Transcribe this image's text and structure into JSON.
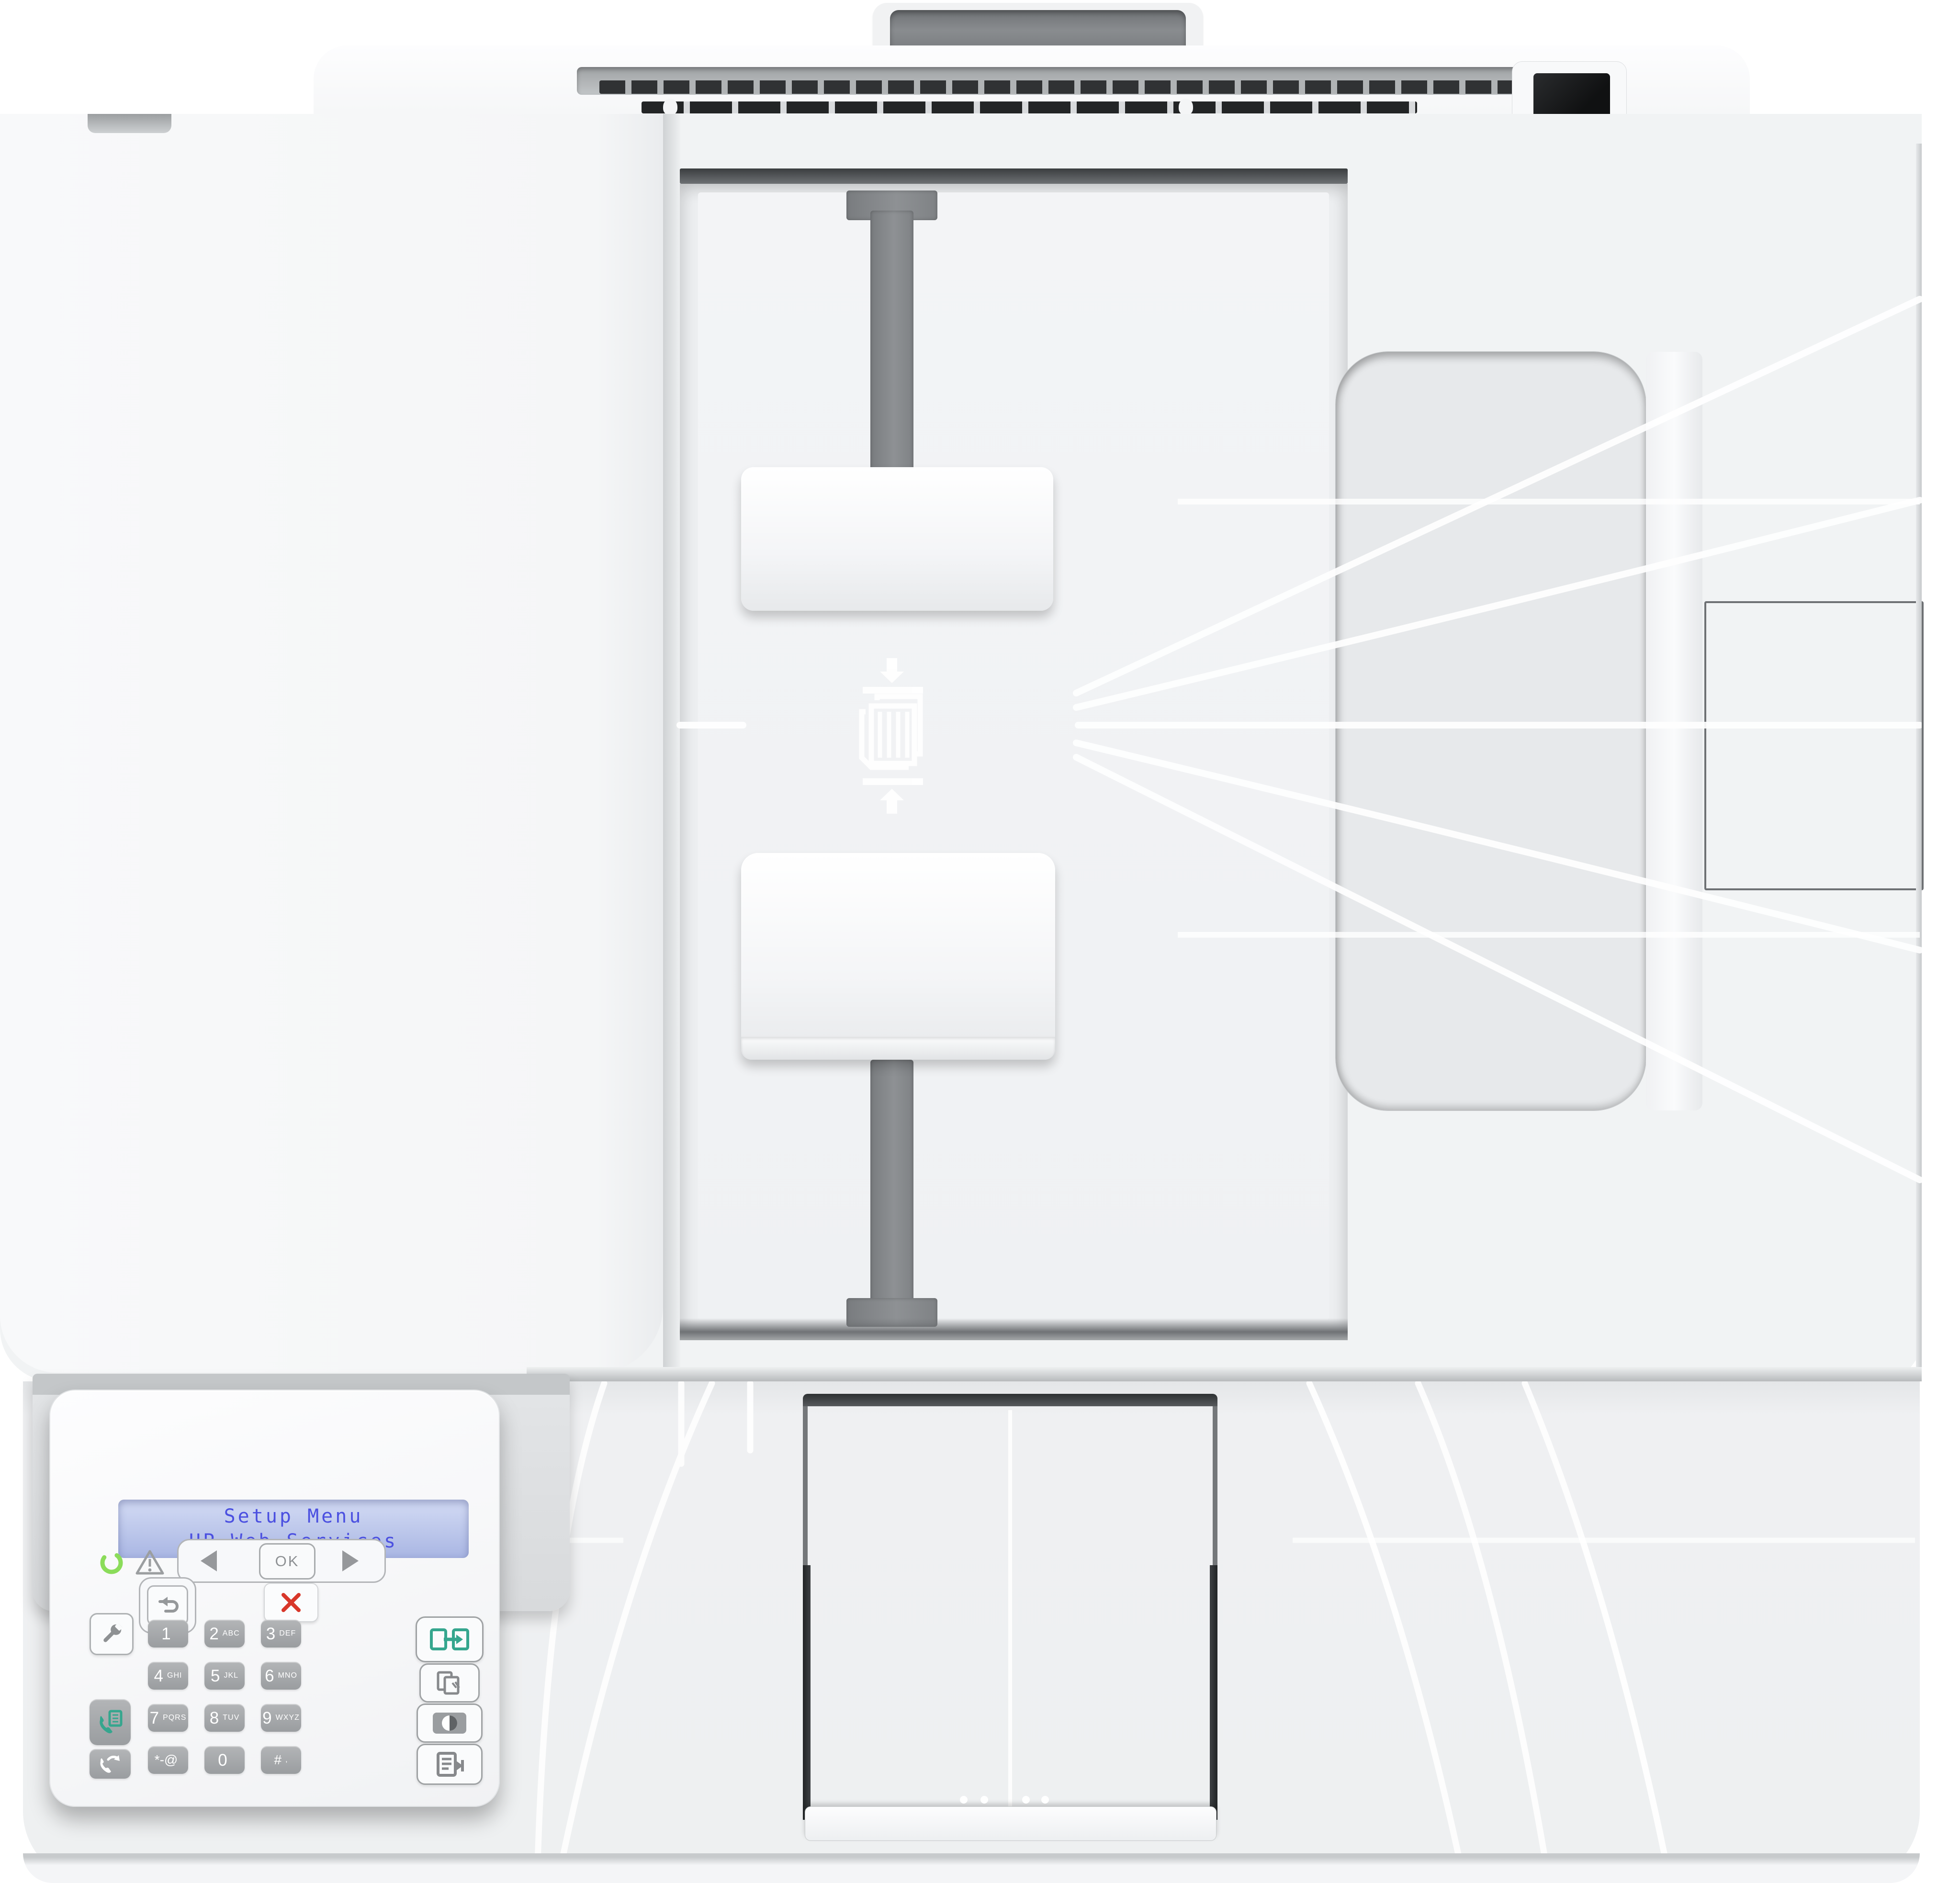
{
  "device": {
    "kind": "multifunction laser printer, top view",
    "body_color": "#f3f4f6",
    "accent_teal": "#35a68e",
    "cancel_red": "#d8372a",
    "led_green": "#8bdc5a"
  },
  "lcd": {
    "line1": "Setup Menu",
    "line2": "HP Web Services",
    "bg_color": "#b9c4ea",
    "text_color": "#4b50e0"
  },
  "nav": {
    "ok_label": "OK"
  },
  "keys": {
    "keypad": [
      {
        "main": "1",
        "sub": ""
      },
      {
        "main": "2",
        "sub": "ABC"
      },
      {
        "main": "3",
        "sub": "DEF"
      },
      {
        "main": "4",
        "sub": "GHI"
      },
      {
        "main": "5",
        "sub": "JKL"
      },
      {
        "main": "6",
        "sub": "MNO"
      },
      {
        "main": "7",
        "sub": "PQRS"
      },
      {
        "main": "8",
        "sub": "TUV"
      },
      {
        "main": "9",
        "sub": "WXYZ"
      },
      {
        "main": "*-@",
        "sub": ""
      },
      {
        "main": "0",
        "sub": ""
      },
      {
        "main": "#",
        "sub": ","
      }
    ]
  },
  "icons": {
    "ready_led": "open green ring",
    "warning": "triangle with exclamation",
    "back": "curved return arrow",
    "cancel": "red X",
    "setup": "wrench",
    "fax": "phone handset with document",
    "redial": "phone handset with arrow",
    "duplex_copy": "two pages with arrow",
    "copies": "stacked pages",
    "contrast": "half-filled circle",
    "copy_settings": "document with lines and arrow",
    "paper_guides": "paper stack squeezed by arrows"
  }
}
